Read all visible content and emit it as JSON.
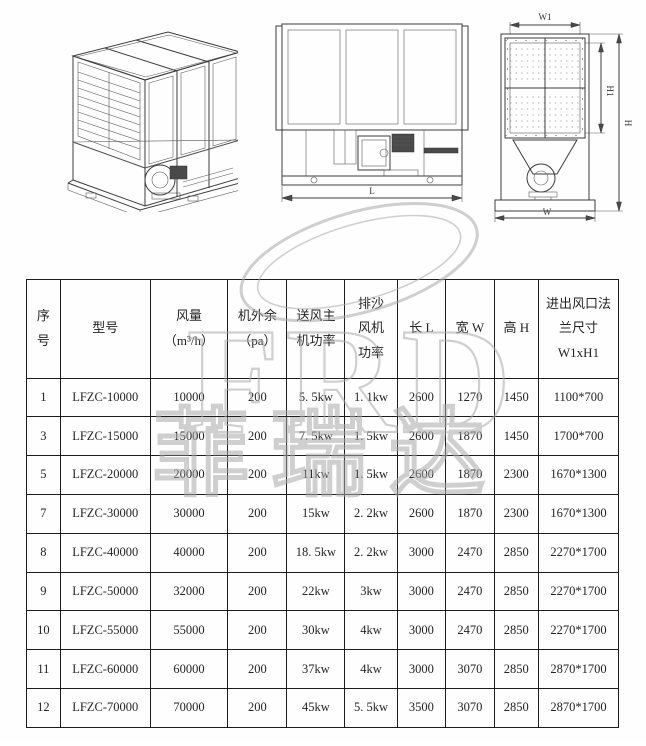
{
  "watermark": {
    "logo_text": "FRD",
    "brand_text": "菲瑞达"
  },
  "drawings": {
    "front_view": {
      "dim_length": "L"
    },
    "side_view": {
      "dim_top_width": "W1",
      "dim_inner_height": "H1",
      "dim_height": "H",
      "dim_width": "W"
    }
  },
  "table": {
    "headers": [
      "序\n号",
      "型号",
      "风量\n（m³/h）",
      "机外余\n（pa）",
      "送风主\n机功率",
      "排沙\n风机\n功率",
      "长 L",
      "宽 W",
      "高 H",
      "进出风口法\n兰尺寸\nW1xH1"
    ],
    "rows": [
      [
        "1",
        "LFZC-10000",
        "10000",
        "200",
        "5. 5kw",
        "1. 1kw",
        "2600",
        "1270",
        "1450",
        "1100*700"
      ],
      [
        "3",
        "LFZC-15000",
        "15000",
        "200",
        "7. 5kw",
        "1. 5kw",
        "2600",
        "1870",
        "1450",
        "1700*700"
      ],
      [
        "5",
        "LFZC-20000",
        "20000",
        "200",
        "11kw",
        "1. 5kw",
        "2600",
        "1870",
        "2300",
        "1670*1300"
      ],
      [
        "7",
        "LFZC-30000",
        "30000",
        "200",
        "15kw",
        "2. 2kw",
        "2600",
        "1870",
        "2300",
        "1670*1300"
      ],
      [
        "8",
        "LFZC-40000",
        "40000",
        "200",
        "18. 5kw",
        "2. 2kw",
        "3000",
        "2470",
        "2850",
        "2270*1700"
      ],
      [
        "9",
        "LFZC-50000",
        "32000",
        "200",
        "22kw",
        "3kw",
        "3000",
        "2470",
        "2850",
        "2270*1700"
      ],
      [
        "10",
        "LFZC-55000",
        "55000",
        "200",
        "30kw",
        "4kw",
        "3000",
        "2470",
        "2850",
        "2270*1700"
      ],
      [
        "11",
        "LFZC-60000",
        "60000",
        "200",
        "37kw",
        "4kw",
        "3000",
        "3070",
        "2850",
        "2870*1700"
      ],
      [
        "12",
        "LFZC-70000",
        "70000",
        "200",
        "45kw",
        "5. 5kw",
        "3500",
        "3070",
        "2850",
        "2870*1700"
      ]
    ]
  }
}
